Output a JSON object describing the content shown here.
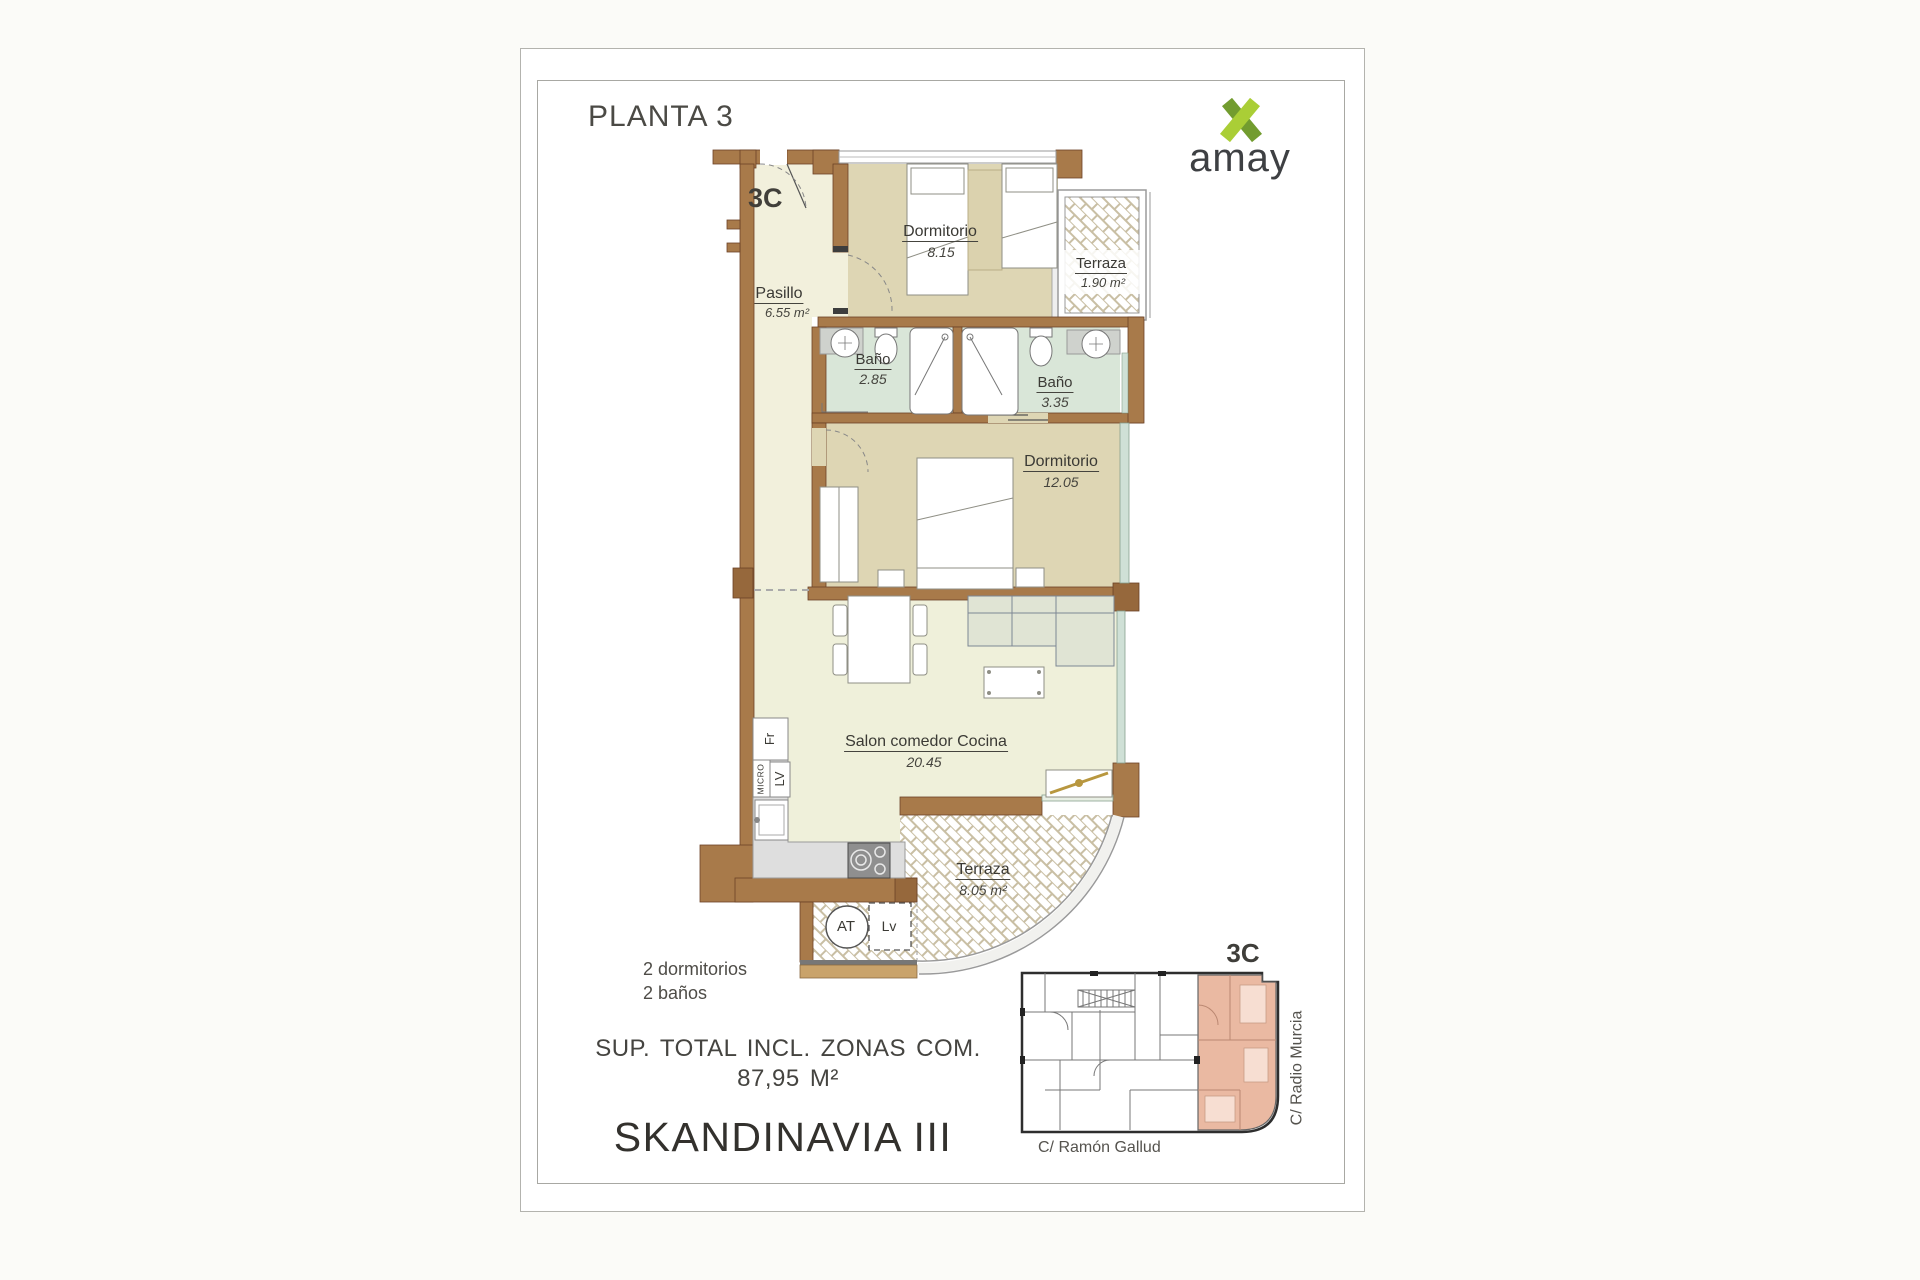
{
  "header": {
    "floor_title": "PLANTA 3",
    "unit": "3C",
    "brand": "amay"
  },
  "plan": {
    "unit_label": "3C",
    "rooms": [
      {
        "id": "dormitorio1",
        "name": "Dormitorio",
        "area": "8.15"
      },
      {
        "id": "terraza1",
        "name": "Terraza",
        "area": "1.90 m²"
      },
      {
        "id": "pasillo",
        "name": "Pasillo",
        "area": "6.55 m²"
      },
      {
        "id": "bano1",
        "name": "Baño",
        "area": "2.85"
      },
      {
        "id": "bano2",
        "name": "Baño",
        "area": "3.35"
      },
      {
        "id": "dormitorio2",
        "name": "Dormitorio",
        "area": "12.05"
      },
      {
        "id": "salon",
        "name": "Salon comedor Cocina",
        "area": "20.45"
      },
      {
        "id": "terraza2",
        "name": "Terraza",
        "area": "8.05 m²"
      }
    ],
    "appliances": {
      "fridge": "Fr",
      "microwave": "MICRO",
      "dishwasher": "LV",
      "water_heater": "AT",
      "washer": "Lv"
    }
  },
  "summary": {
    "bedrooms": "2 dormitorios",
    "bathrooms": "2 baños",
    "total_line1": "SUP. TOTAL INCL. ZONAS COM.",
    "total_line2": "87,95 M²",
    "project": "SKANDINAVIA III"
  },
  "keyplan": {
    "unit": "3C",
    "street_bottom": "C/ Ramón Gallud",
    "street_right": "C/ Radio Murcia"
  },
  "colors": {
    "wall": "#a87a4a",
    "wall_dark": "#6b4226",
    "floor_cream": "#f2f0dc",
    "floor_tan": "#ded6b4",
    "floor_bath": "#d9e6d8",
    "floor_salon": "#eff0da",
    "bath_counter": "#cfd2cd",
    "sofa": "#e0e4d4",
    "tile_line": "#c9bfa4",
    "highlight_unit": "#eab9a2",
    "brand_green_light": "#aace36",
    "brand_green_dark": "#729c2f",
    "text_dark": "#3b3a35"
  }
}
